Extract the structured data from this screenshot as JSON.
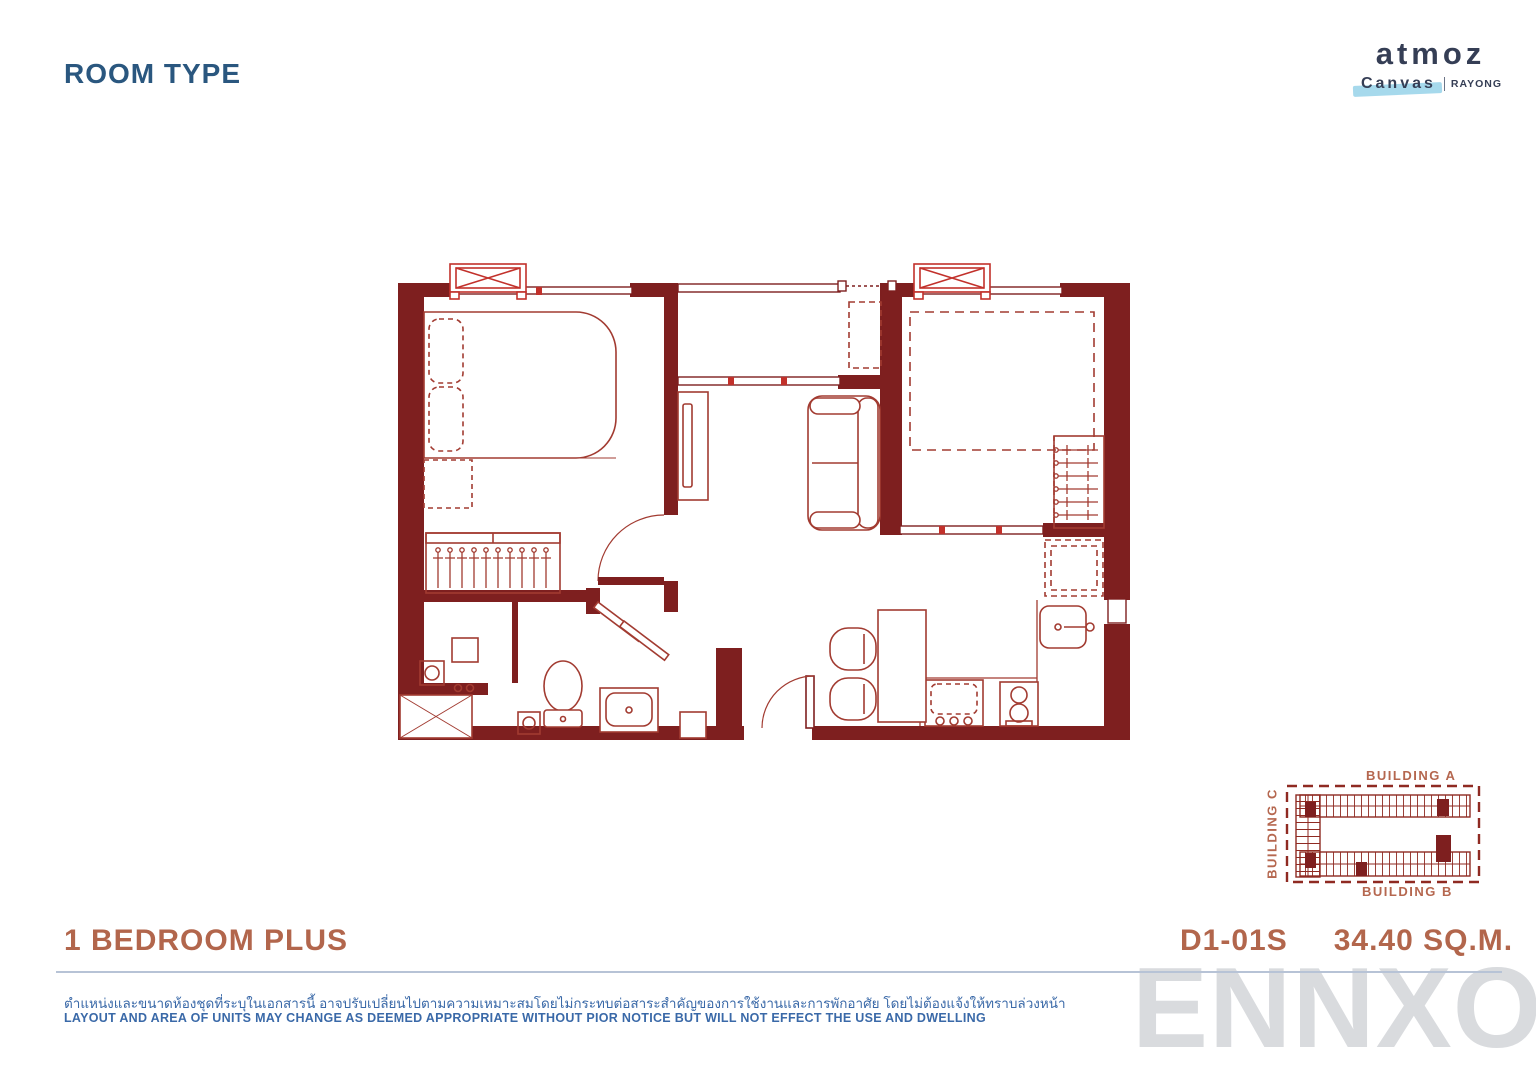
{
  "page": {
    "title": "ROOM TYPE"
  },
  "brand": {
    "name": "atmoz",
    "sub_brand": "Canvas",
    "location": "RAYONG"
  },
  "unit": {
    "type_label": "1 BEDROOM PLUS",
    "code": "D1-01S",
    "area": "34.40 SQ.M."
  },
  "site_map": {
    "building_a": "BUILDING A",
    "building_b": "BUILDING B",
    "building_c": "BUILDING C"
  },
  "disclaimer": {
    "thai": "ตำแหน่งและขนาดห้องชุดที่ระบุในเอกสารนี้ อาจปรับเปลี่ยนไปตามความเหมาะสมโดยไม่กระทบต่อสาระสำคัญของการใช้งานและการพักอาศัย โดยไม่ต้องแจ้งให้ทราบล่วงหน้า",
    "english": "LAYOUT AND AREA OF UNITS MAY CHANGE AS DEEMED APPROPRIATE WITHOUT PIOR NOTICE BUT WILL NOT EFFECT THE USE AND DWELLING"
  },
  "watermark": "ENNXO",
  "colors": {
    "wall": "#7E1F1F",
    "furniture_line": "#A23B31",
    "ac_red": "#C2312B",
    "title_blue": "#2a577f",
    "terracotta": "#b2664c",
    "disclaimer_blue": "#3a69a8",
    "brush_blue": "#a6d9ec",
    "watermark_gray": "#d9dbde"
  },
  "floor_plan": {
    "rooms": [
      {
        "name": "Bedroom",
        "furniture": [
          "double-bed",
          "pillows",
          "wardrobe-with-hangers"
        ]
      },
      {
        "name": "Bathroom",
        "furniture": [
          "shower",
          "toilet",
          "wash-basin",
          "floor-drains"
        ]
      },
      {
        "name": "Living Area",
        "furniture": [
          "sofa",
          "tv-console"
        ]
      },
      {
        "name": "Plus Room",
        "furniture": [
          "bed-outline-dashed",
          "wardrobe-with-hangers"
        ]
      },
      {
        "name": "Kitchen-Dining",
        "furniture": [
          "refrigerator",
          "sink",
          "stove-2-burner",
          "counter",
          "dining-table",
          "two-chairs"
        ]
      },
      {
        "name": "AC Ledge",
        "furniture": [
          "condensing-unit",
          "railing"
        ]
      }
    ],
    "air_conditioners": 2,
    "entrance": "bottom-center door with swing arc"
  }
}
